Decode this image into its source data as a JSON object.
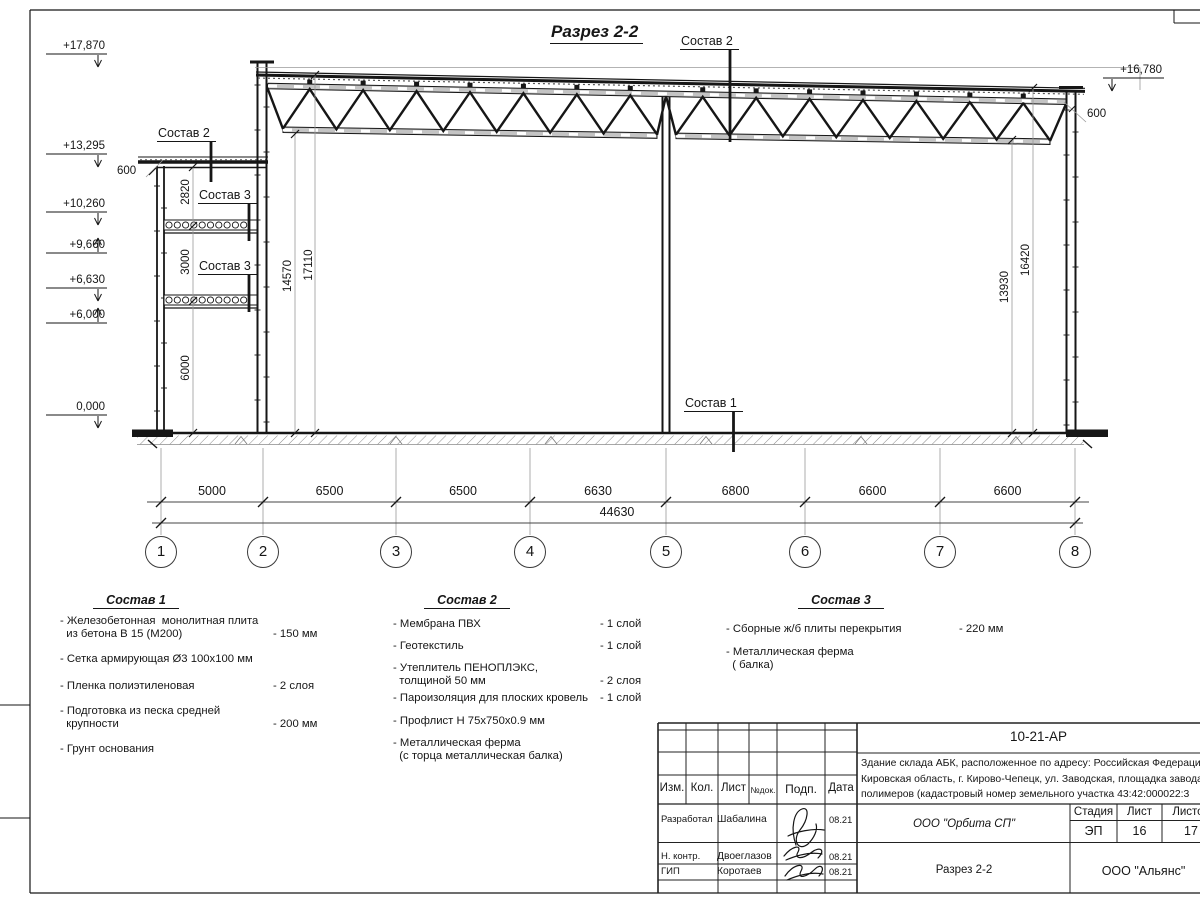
{
  "drawing": {
    "title": "Разрез 2-2",
    "elevations": [
      {
        "label": "+17,870",
        "y": 54,
        "dir": "down"
      },
      {
        "label": "+13,295",
        "y": 154,
        "dir": "down"
      },
      {
        "label": "+10,260",
        "y": 212,
        "dir": "down"
      },
      {
        "label": "+9,660",
        "y": 253,
        "dir": "up"
      },
      {
        "label": "+6,630",
        "y": 288,
        "dir": "down"
      },
      {
        "label": "+6,000",
        "y": 323,
        "dir": "up"
      },
      {
        "label": "0,000",
        "y": 415,
        "dir": "down"
      },
      {
        "label": "+16,780",
        "y": 78,
        "dir": "down",
        "x": 1103
      }
    ],
    "callouts": [
      {
        "label": "Состав 2",
        "x": 680,
        "y": 34
      },
      {
        "label": "Состав 2",
        "x": 157,
        "y": 126
      },
      {
        "label": "Состав 3",
        "x": 198,
        "y": 188
      },
      {
        "label": "Состав 3",
        "x": 198,
        "y": 259
      },
      {
        "label": "Состав 1",
        "x": 684,
        "y": 396
      }
    ],
    "small_dims": [
      {
        "label": "600",
        "x": 117,
        "y": 165
      },
      {
        "label": "600",
        "x": 1087,
        "y": 108
      }
    ],
    "vertical_dims": [
      {
        "label": "2820",
        "x": 186,
        "y": 193
      },
      {
        "label": "3000",
        "x": 186,
        "y": 263
      },
      {
        "label": "6000",
        "x": 186,
        "y": 369
      },
      {
        "label": "14570",
        "x": 288,
        "y": 277
      },
      {
        "label": "17110",
        "x": 309,
        "y": 266
      },
      {
        "label": "13930",
        "x": 1005,
        "y": 288
      },
      {
        "label": "16420",
        "x": 1026,
        "y": 261
      }
    ],
    "axes": [
      "1",
      "2",
      "3",
      "4",
      "5",
      "6",
      "7",
      "8"
    ],
    "span_dims": [
      "5000",
      "6500",
      "6500",
      "6630",
      "6800",
      "6600",
      "6600"
    ],
    "total_dim": "44630"
  },
  "compositions": [
    {
      "title": "Состав 1",
      "items": [
        {
          "text": "- Железобетонная  монолитная плита\n  из бетона В 15 (М200)",
          "value": "- 150 мм"
        },
        {
          "text": "- Сетка армирующая Ø3 100х100 мм",
          "value": ""
        },
        {
          "text": "- Пленка полиэтиленовая",
          "value": "-  2 слоя"
        },
        {
          "text": "- Подготовка из песка средней\n  крупности",
          "value": "- 200 мм"
        },
        {
          "text": "- Грунт основания",
          "value": ""
        }
      ]
    },
    {
      "title": "Состав 2",
      "items": [
        {
          "text": "- Мембрана ПВХ",
          "value": "- 1 слой"
        },
        {
          "text": "- Геотекстиль",
          "value": "- 1 слой"
        },
        {
          "text": "- Утеплитель ПЕНОПЛЭКС,\n  толщиной 50 мм",
          "value": "- 2 слоя"
        },
        {
          "text": "- Пароизоляция для плоских кровель",
          "value": "- 1 слой"
        },
        {
          "text": "- Профлист Н 75х750х0.9 мм",
          "value": ""
        },
        {
          "text": "- Металлическая ферма\n  (с торца металлическая балка)",
          "value": ""
        }
      ]
    },
    {
      "title": "Состав 3",
      "items": [
        {
          "text": "- Сборные ж/б плиты перекрытия",
          "value": "- 220 мм"
        },
        {
          "text": "- Металлическая ферма\n  ( балка)",
          "value": ""
        }
      ]
    }
  ],
  "title_block": {
    "doc_number": "10-21-АР",
    "description": "Здание склада АБК, расположенное по адресу: Российская Федерация,\nКировская область, г. Кирово-Чепецк, ул. Заводская, площадка завода\nполимеров (кадастровый номер земельного участка 43:42:000022:3",
    "header_cols": [
      "Изм.",
      "Кол.",
      "Лист",
      "№док.",
      "Подп.",
      "Дата"
    ],
    "signature_rows": [
      {
        "role": "Разработал",
        "name": "Шабалина",
        "date": "08.21"
      },
      {
        "role": "Н. контр.",
        "name": "Двоеглазов",
        "date": "08.21"
      },
      {
        "role": "ГИП",
        "name": "Коротаев",
        "date": "08.21"
      }
    ],
    "company": "ООО \"Орбита СП\"",
    "stage_label": "Стадия",
    "sheet_label": "Лист",
    "sheets_label": "Листов",
    "stage": "ЭП",
    "sheet": "16",
    "sheets": "17",
    "section_name": "Разрез 2-2",
    "contractor": "ООО \"Альянс\""
  }
}
